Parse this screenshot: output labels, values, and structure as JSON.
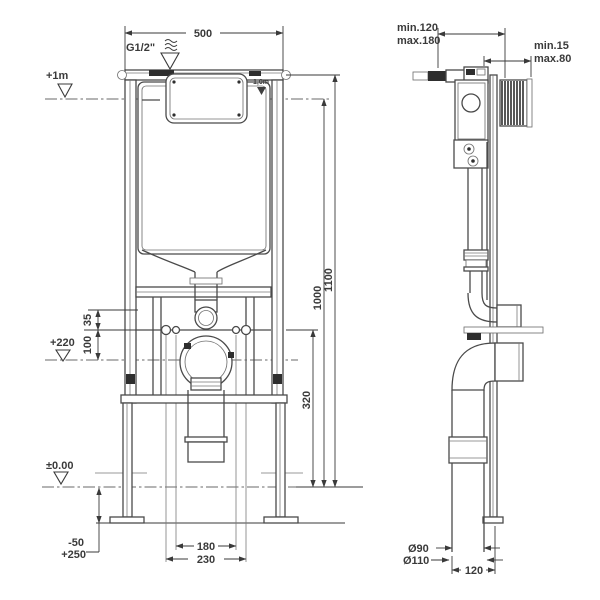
{
  "front": {
    "dim_width_top": "500",
    "water_supply_label": "G1/2\"",
    "level_plus_1m": "+1m",
    "cistern_water_level": "1,0m",
    "dim_35": "35",
    "dim_100": "100",
    "level_plus_220": "+220",
    "dim_320": "320",
    "dim_1000": "1000",
    "dim_1100": "1100",
    "level_zero": "±0.00",
    "foot_adjust_minus": "-50",
    "foot_adjust_plus": "+250",
    "dim_bolt_inner": "180",
    "dim_bolt_outer": "230"
  },
  "side": {
    "rod_min": "min.120",
    "rod_max": "max.180",
    "wall_min": "min.15",
    "wall_max": "max.80",
    "dia_90": "Ø90",
    "dia_110": "Ø110",
    "dim_depth": "120"
  }
}
